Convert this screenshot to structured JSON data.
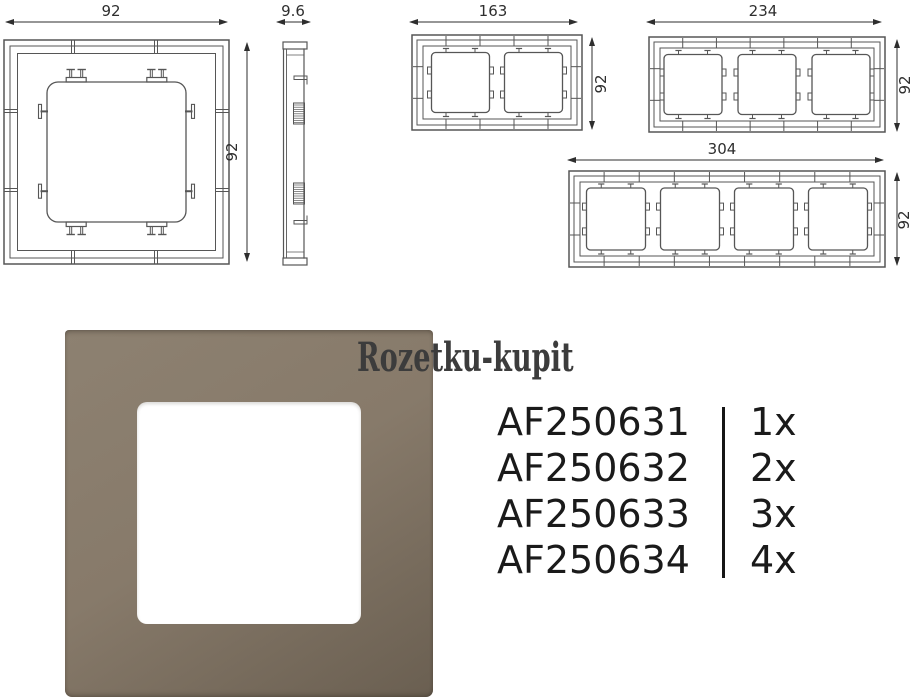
{
  "watermark": {
    "text": "Rozetku-kupit",
    "color": "#3c3c3c"
  },
  "drawings": {
    "stroke_color": "#565656",
    "dim_color": "#2e2e2e",
    "views": [
      {
        "id": "front-1gang",
        "label": "1-gang frame front view",
        "width_label": "92",
        "height_label": "92"
      },
      {
        "id": "side-profile",
        "label": "frame side profile",
        "width_label": "9.6"
      },
      {
        "id": "front-2gang",
        "label": "2-gang frame front view",
        "width_label": "163",
        "height_label": "92"
      },
      {
        "id": "front-3gang",
        "label": "3-gang frame front view",
        "width_label": "234",
        "height_label": "92"
      },
      {
        "id": "front-4gang",
        "label": "4-gang frame front view",
        "width_label": "304",
        "height_label": "92"
      }
    ]
  },
  "product_photo": {
    "frame_color_top": "#8d8171",
    "frame_color_mid": "#877a6a",
    "frame_color_bottom": "#6a5f51",
    "cutout_color": "#ffffff"
  },
  "parts_table": {
    "divider_color": "#161616",
    "rows": [
      {
        "part_number": "AF250631",
        "quantity": "1x"
      },
      {
        "part_number": "AF250632",
        "quantity": "2x"
      },
      {
        "part_number": "AF250633",
        "quantity": "3x"
      },
      {
        "part_number": "AF250634",
        "quantity": "4x"
      }
    ]
  }
}
